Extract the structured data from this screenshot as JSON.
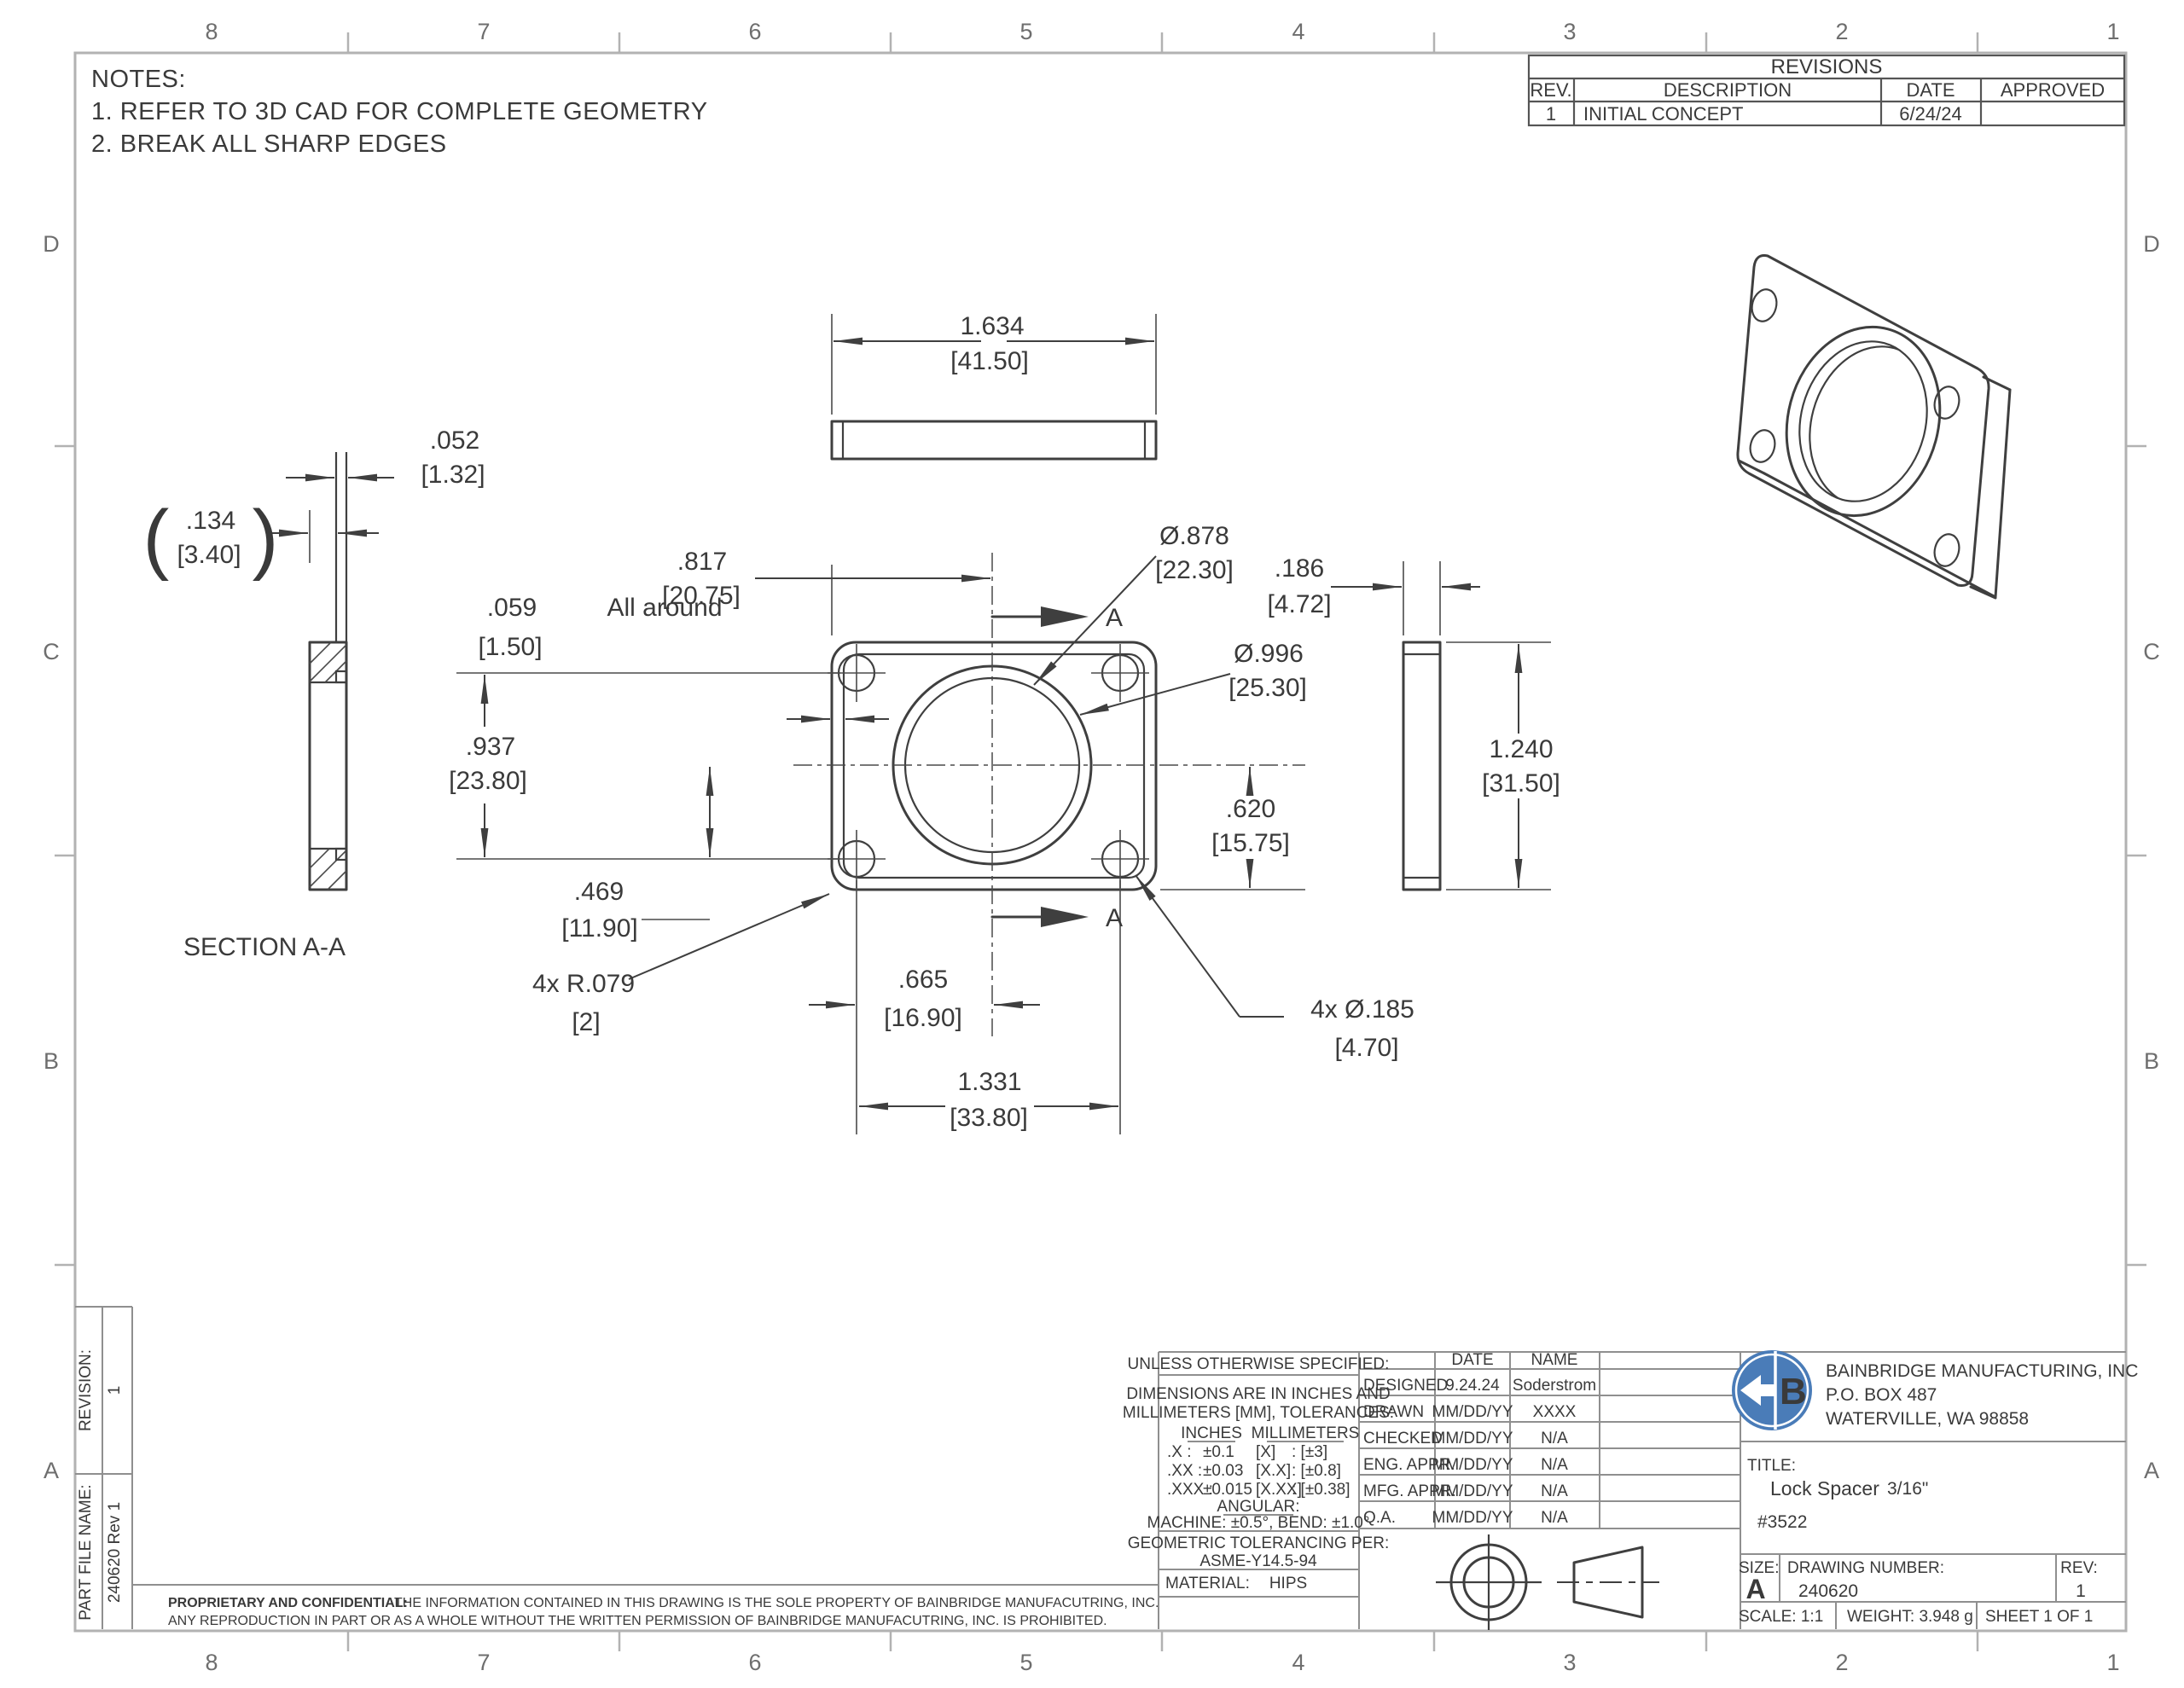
{
  "zones": {
    "top": [
      "8",
      "7",
      "6",
      "5",
      "4",
      "3",
      "2",
      "1"
    ],
    "bottom": [
      "8",
      "7",
      "6",
      "5",
      "4",
      "3",
      "2",
      "1"
    ],
    "left": [
      "D",
      "C",
      "B",
      "A"
    ],
    "right": [
      "D",
      "C",
      "B",
      "A"
    ]
  },
  "notes": {
    "title": "NOTES:",
    "n1": "1.  REFER TO 3D CAD FOR COMPLETE GEOMETRY",
    "n2": "2.  BREAK ALL SHARP EDGES"
  },
  "revisions": {
    "title": "REVISIONS",
    "h_rev": "REV.",
    "h_desc": "DESCRIPTION",
    "h_date": "DATE",
    "h_appr": "APPROVED",
    "r1_rev": "1",
    "r1_desc": "INITIAL CONCEPT",
    "r1_date": "6/24/24",
    "r1_appr": ""
  },
  "labels": {
    "section": "SECTION A-A",
    "a": "A",
    "paren_l": "(",
    "paren_r": ")"
  },
  "dims": {
    "d1634": {
      "in": "1.634",
      "mm": "[41.50]"
    },
    "d817": {
      "in": ".817",
      "mm": "[20.75]"
    },
    "d059": {
      "in": ".059",
      "note": "All around",
      "mm": "[1.50]"
    },
    "d937": {
      "in": ".937",
      "mm": "[23.80]"
    },
    "d469": {
      "in": ".469",
      "mm": "[11.90]"
    },
    "r079": {
      "in": "4x R.079",
      "mm": "[2]"
    },
    "d665": {
      "in": ".665",
      "mm": "[16.90]"
    },
    "d1331": {
      "in": "1.331",
      "mm": "[33.80]"
    },
    "d185": {
      "in": "4x Ø.185",
      "mm": "[4.70]"
    },
    "d878": {
      "in": "Ø.878",
      "mm": "[22.30]"
    },
    "d996": {
      "in": "Ø.996",
      "mm": "[25.30]"
    },
    "d620": {
      "in": ".620",
      "mm": "[15.75]"
    },
    "d186": {
      "in": ".186",
      "mm": "[4.72]"
    },
    "d1240": {
      "in": "1.240",
      "mm": "[31.50]"
    },
    "d052": {
      "in": ".052",
      "mm": "[1.32]"
    },
    "d134": {
      "in": ".134",
      "mm": "[3.40]"
    }
  },
  "tb": {
    "uos": "UNLESS OTHERWISE SPECIFIED:",
    "dims1": "DIMENSIONS ARE IN INCHES AND",
    "dims2": "MILLIMETERS [MM], TOLERANCES:",
    "inches": "INCHES",
    "millimeters": "MILLIMETERS",
    "t1a": ".X :",
    "t1b": "±0.1",
    "t1c": "[X]",
    "t1d": ": [±3]",
    "t2a": ".XX :",
    "t2b": "±0.03",
    "t2c": "[X.X]",
    "t2d": ": [±0.8]",
    "t3a": ".XXX :",
    "t3b": "±0.015",
    "t3c": "[X.XX]",
    "t3d": ": [±0.38]",
    "angular": "ANGULAR:",
    "machine": "MACHINE: ±0.5°, BEND: ±1.0°",
    "geo1": "GEOMETRIC TOLERANCING PER:",
    "geo2": "ASME-Y14.5-94",
    "material": "MATERIAL:",
    "material_v": "HIPS",
    "date": "DATE",
    "name": "NAME",
    "rows": [
      [
        "DESIGNED",
        "9.24.24",
        "Soderstrom"
      ],
      [
        "DRAWN",
        "MM/DD/YY",
        "XXXX"
      ],
      [
        "CHECKED",
        "MM/DD/YY",
        "N/A"
      ],
      [
        "ENG. APPR.",
        "MM/DD/YY",
        "N/A"
      ],
      [
        "MFG. APPR.",
        "MM/DD/YY",
        "N/A"
      ],
      [
        "Q.A.",
        "MM/DD/YY",
        "N/A"
      ]
    ],
    "company1": "BAINBRIDGE MANUFACTURING, INC",
    "company2": "P.O. BOX 487",
    "company3": "WATERVILLE, WA 98858",
    "logo_b": "B",
    "title_l": "TITLE:",
    "title_v": "Lock Spacer",
    "title_s": "3/16\"",
    "part_no": "#3522",
    "size_l": "SIZE:",
    "size_v": "A",
    "dwg_l": "DRAWING NUMBER:",
    "dwg_v": "240620",
    "rev_l": "REV:",
    "rev_v": "1",
    "scale": "SCALE: 1:1",
    "weight": "WEIGHT: 3.948 g",
    "sheet": "SHEET 1 OF 1",
    "revision_l": "REVISION:",
    "revision_v": "1",
    "pfn_l": "PART FILE NAME:",
    "pfn_v": "240620 Rev 1",
    "prop_b": "PROPRIETARY AND CONFIDENTIAL:",
    "prop1": "THE INFORMATION CONTAINED IN THIS DRAWING IS THE SOLE PROPERTY OF BAINBRIDGE MANUFACUTRING, INC.",
    "prop2": "ANY REPRODUCTION IN PART OR AS A WHOLE WITHOUT THE WRITTEN PERMISSION OF BAINBRIDGE MANUFACUTRING, INC. IS PROHIBITED."
  },
  "colors": {
    "accent": "#4a7cb8",
    "line": "#3f3f3f",
    "frame": "#b2b2b2"
  }
}
